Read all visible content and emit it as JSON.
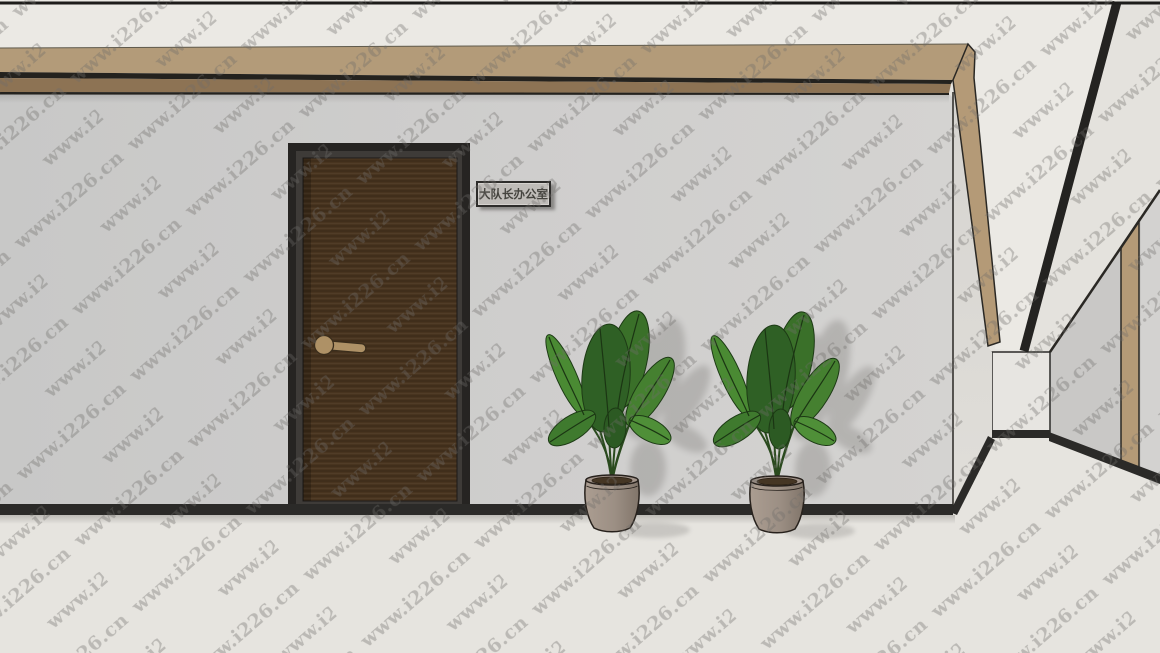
{
  "watermark": {
    "text": "www.i226.cn"
  },
  "sign": {
    "text": "大队长办公室",
    "background": "#bfbcb8",
    "border": "#2e2d2b",
    "text_color": "#45443f"
  },
  "plants": {
    "count": 2
  },
  "palette": {
    "ceiling": "#ebe9e4",
    "beam_wood_top": "#b39b79",
    "beam_wood_shadow_band": "#8d7354",
    "corner_trim_wood": "#b49a77",
    "wall": "#cecdcc",
    "return_wall": "#dcdad6",
    "end_wall": "#e7e5e1",
    "right_wall": "#c9c8c6",
    "floor": "#e6e4df",
    "baseboard": "#2b2a28",
    "door_wood": "#48341f",
    "door_frame": "#262422",
    "door_handle": "#ae9166",
    "leaf_green_dark": "#2f6025",
    "leaf_green_light": "#4f8f38",
    "plant_pot": "#a2948a",
    "watermark_gray": "#6e6c69"
  }
}
